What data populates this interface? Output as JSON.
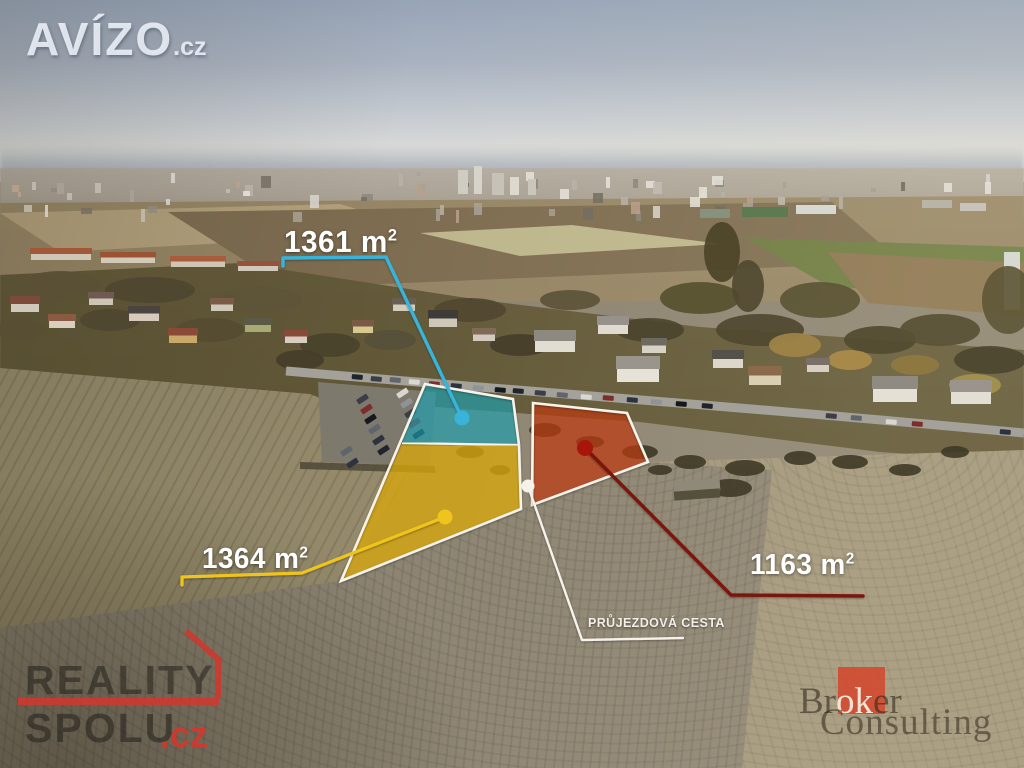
{
  "watermarks": {
    "avizo": {
      "name": "AVÍZO",
      "tld": ".cz"
    },
    "reality_spolu": {
      "word1": "REALITY",
      "word2": "SPOLU",
      "tld": ".cz",
      "accent_color": "#d0382e"
    },
    "broker_consulting": {
      "word1_pre": "Br",
      "word1_mid": "ok",
      "word1_post": "er",
      "word2": "Consulting",
      "accent_color": "#d3482d"
    }
  },
  "plots": {
    "teal": {
      "value": "1361",
      "unit": "m",
      "sup": "2",
      "overlay_color": "#1f9fae",
      "line_color": "#38b3da"
    },
    "yellow": {
      "value": "1364",
      "unit": "m",
      "sup": "2",
      "overlay_color": "#d7a60b",
      "line_color": "#efc41f"
    },
    "red": {
      "value": "1163",
      "unit": "m",
      "sup": "2",
      "overlay_color": "#bc3a10",
      "line_color": "#7c130e"
    }
  },
  "road_label": "PRŮJEZDOVÁ CESTA",
  "outline_color": "#f7f3ea",
  "marker_white": "#f5f2ea"
}
